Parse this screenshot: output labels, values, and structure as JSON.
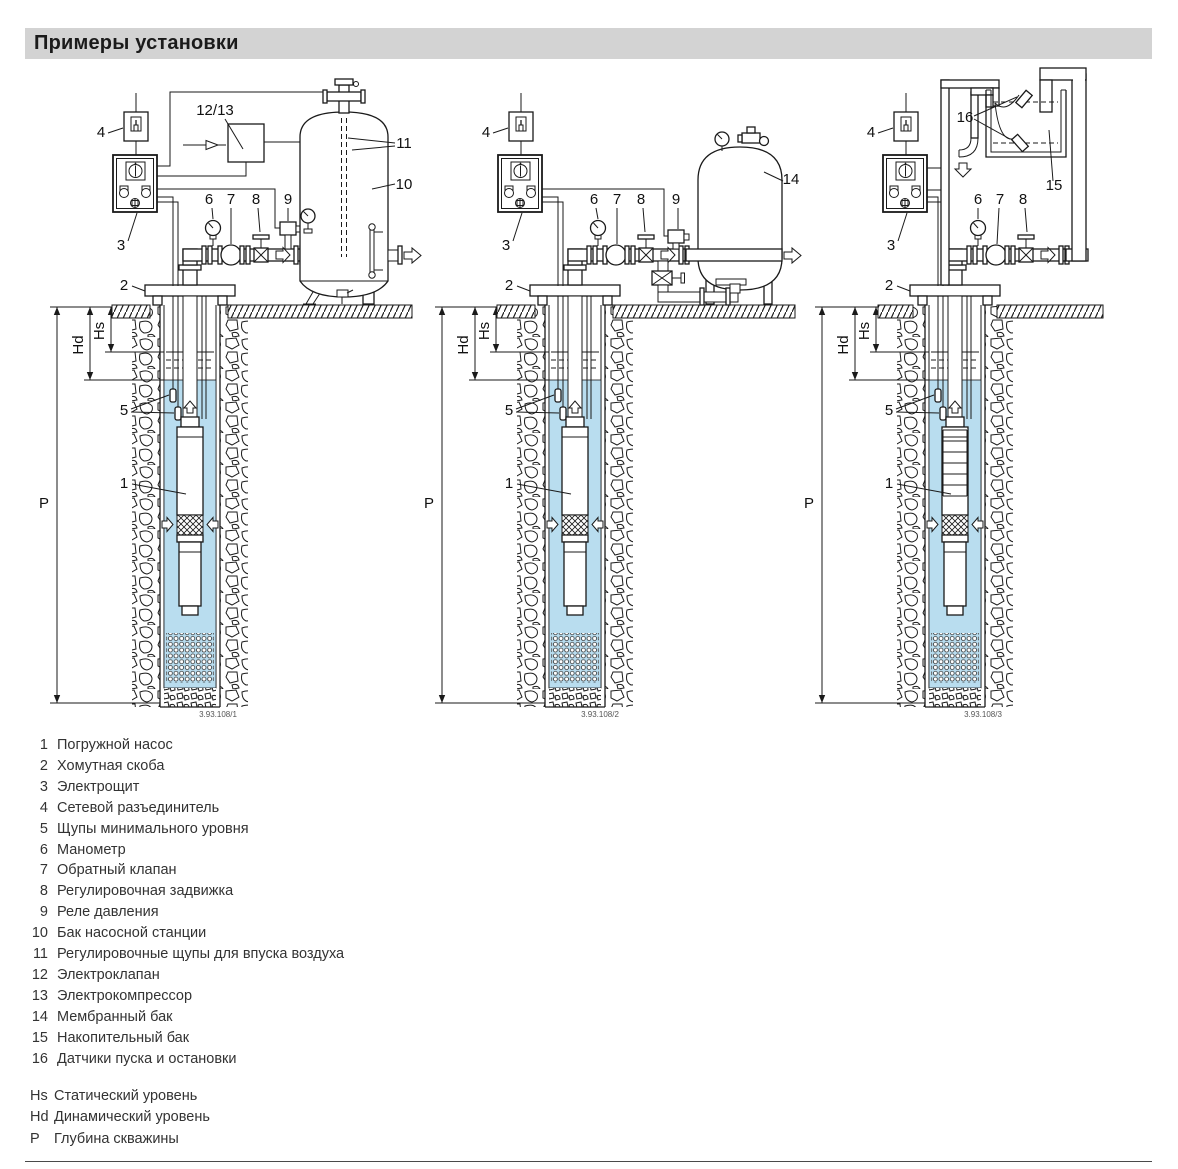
{
  "page": {
    "title": "Примеры установки"
  },
  "colors": {
    "water": "#b9ddef",
    "header_bg": "#d3d3d3"
  },
  "callouts": {
    "n1": "1",
    "n2": "2",
    "n3": "3",
    "n4": "4",
    "n5": "5",
    "n6": "6",
    "n7": "7",
    "n8": "8",
    "n9": "9",
    "n10": "10",
    "n11": "11",
    "n12_13": "12/13",
    "n14": "14",
    "n15": "15",
    "n16": "16",
    "hs": "Hs",
    "hd": "Hd",
    "p": "P"
  },
  "diagrams": [
    {
      "figure_number": "3.93.108/1"
    },
    {
      "figure_number": "3.93.108/2"
    },
    {
      "figure_number": "3.93.108/3"
    }
  ],
  "legend": {
    "items": [
      {
        "num": "1",
        "label": "Погружной насос"
      },
      {
        "num": "2",
        "label": "Хомутная скоба"
      },
      {
        "num": "3",
        "label": "Электрощит"
      },
      {
        "num": "4",
        "label": "Сетевой разъединитель"
      },
      {
        "num": "5",
        "label": "Щупы минимального уровня"
      },
      {
        "num": "6",
        "label": "Манометр"
      },
      {
        "num": "7",
        "label": "Обратный клапан"
      },
      {
        "num": "8",
        "label": "Регулировочная задвижка"
      },
      {
        "num": "9",
        "label": "Реле давления"
      },
      {
        "num": "10",
        "label": "Бак насосной станции"
      },
      {
        "num": "11",
        "label": "Регулировочные щупы для впуска воздуха"
      },
      {
        "num": "12",
        "label": "Электроклапан"
      },
      {
        "num": "13",
        "label": "Электрокомпрессор"
      },
      {
        "num": "14",
        "label": "Мембранный бак"
      },
      {
        "num": "15",
        "label": "Накопительный бак"
      },
      {
        "num": "16",
        "label": "Датчики пуска и остановки"
      }
    ]
  },
  "levels": [
    {
      "sym": "Hs",
      "label": "Статический уровень"
    },
    {
      "sym": "Hd",
      "label": "Динамический уровень"
    },
    {
      "sym": "P",
      "label": "Глубина скважины"
    }
  ]
}
